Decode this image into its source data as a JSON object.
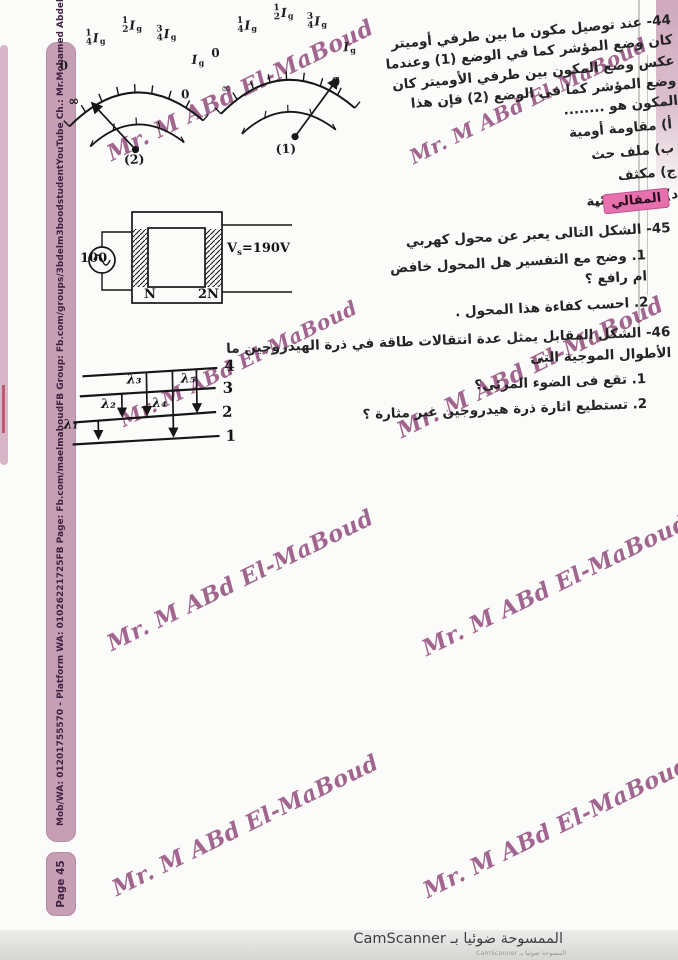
{
  "watermark_text": "Mr. M ABd El-MaBoud",
  "sidebar": {
    "items": [
      "Mob/WA: 01201755570 - Platform WA: 01026221725",
      "FB Page: Fb.com/maelmaboud",
      "FB Group: Fb.com/groups/3bdelm3boodstudent",
      "YouTube Ch.: Mr.Mohamed AbdelMaboud"
    ],
    "page_badge": "Page 45"
  },
  "section_badge": "المقالي",
  "section_badge_dash": "-",
  "q44": {
    "text": "44- عند توصيل مكون ما بين طرفي أوميتر كان وضع المؤشر كما في الوضع (1) وعندما عكس وضع المكون بين طرفي الأوميتر كان وضع المؤشر كما في الوضع (2) فإن هذا المكون هو ........",
    "options": [
      "أ) مقاومة أومية",
      "ب) ملف حث",
      "ج) مكثف",
      "د) وصلة ثنائية"
    ]
  },
  "meter": {
    "zero": "0",
    "fractions": [
      {
        "n": "1",
        "d": "4"
      },
      {
        "n": "1",
        "d": "2"
      },
      {
        "n": "3",
        "d": "4"
      }
    ],
    "unit": {
      "main": "I",
      "sub": "g"
    },
    "inf": "∞",
    "ohm_zero": "0",
    "left_tag": "(2)",
    "right_tag": "(1)"
  },
  "q45": {
    "text": "45- الشكل التالى يعبر عن محول كهربي",
    "items": [
      "1. وضح مع التفسير هل المحول خافض ام رافع ؟",
      "2. احسب كفاءة هذا المحول ."
    ],
    "transformer": {
      "source_label": "100",
      "primary_turns": "N",
      "secondary_turns": "2N",
      "vs": {
        "main": "V",
        "sub": "s",
        "value": "=190V"
      }
    }
  },
  "q46": {
    "text": "46- الشكل المقابل يمثل عدة انتقالات طاقة في ذرة الهيدروجين ما الأطوال الموجية التى",
    "items": [
      "1. تقع فى الضوء المرئى؟",
      "2. تستطيع اثارة ذرة هيدروجين غير مثارة ؟"
    ]
  },
  "energy": {
    "levels": [
      "4",
      "3",
      "2",
      "1"
    ],
    "transitions": [
      {
        "label": "λ₁",
        "from": "2",
        "to": "1"
      },
      {
        "label": "λ₂",
        "from": "3",
        "to": "2"
      },
      {
        "label": "λ₃",
        "from": "4",
        "to": "2"
      },
      {
        "label": "λ₄",
        "from": "4",
        "to": "1"
      },
      {
        "label": "λ₅",
        "from": "4",
        "to": "2"
      }
    ]
  },
  "footer": {
    "scanned_by": "الممسوحة ضوئيا بـ CamScanner",
    "scanned_by_small": "المسوحة ضوئيا بـ CamScanner"
  },
  "colors": {
    "sidebar": "#c79fb4",
    "watermark": "#8e4579",
    "badge": "#e770ae"
  }
}
